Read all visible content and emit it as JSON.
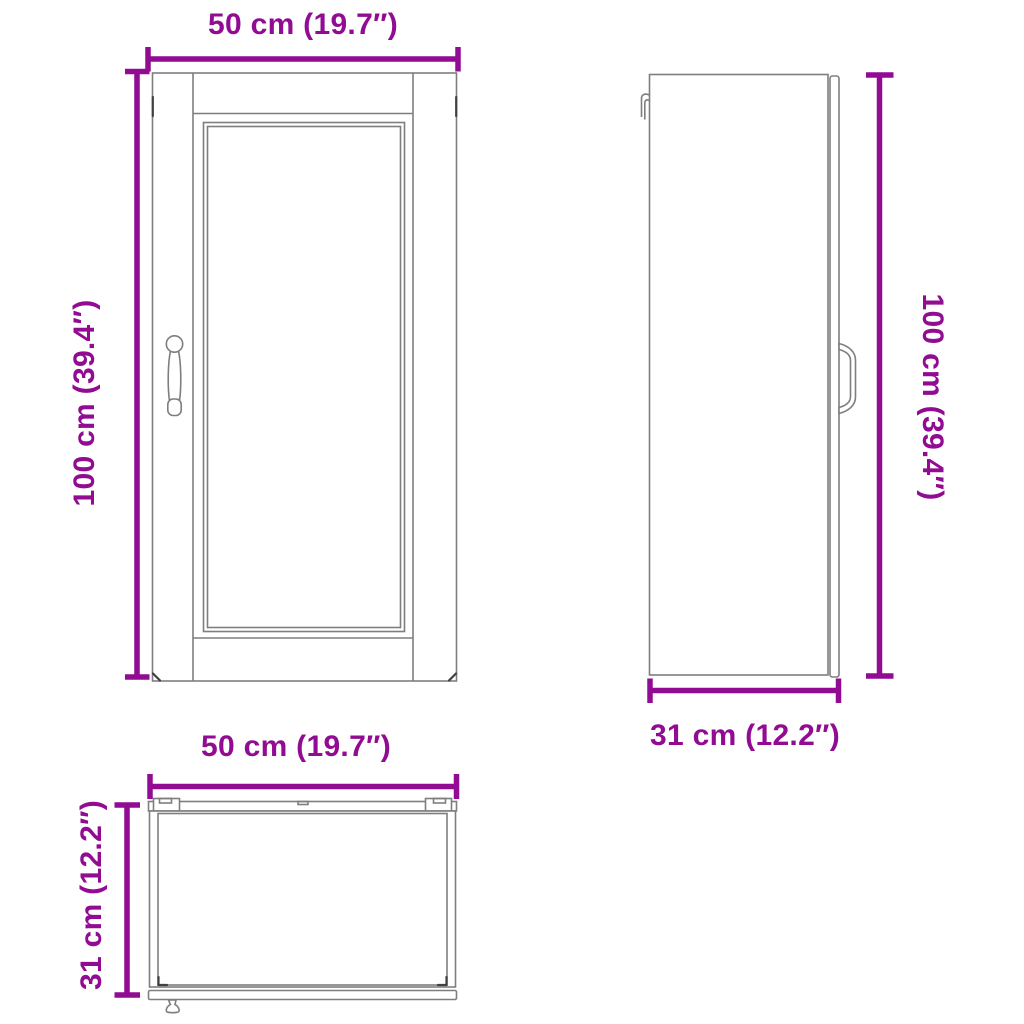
{
  "views": {
    "front": {
      "width_label": "50 cm (19.7″)",
      "height_label": "100 cm (39.4″)"
    },
    "side": {
      "height_label": "100 cm (39.4″)",
      "depth_label": "31 cm (12.2″)"
    },
    "top": {
      "width_label": "50 cm (19.7″)",
      "depth_label": "31 cm (12.2″)"
    }
  },
  "measurements": {
    "width_cm": 50,
    "width_in": "19.7",
    "height_cm": 100,
    "height_in": "39.4",
    "depth_cm": 31,
    "depth_in": "12.2"
  },
  "colors": {
    "dimension_accent": "#910c92",
    "outline": "#7e7e7e",
    "background": "#ffffff"
  }
}
